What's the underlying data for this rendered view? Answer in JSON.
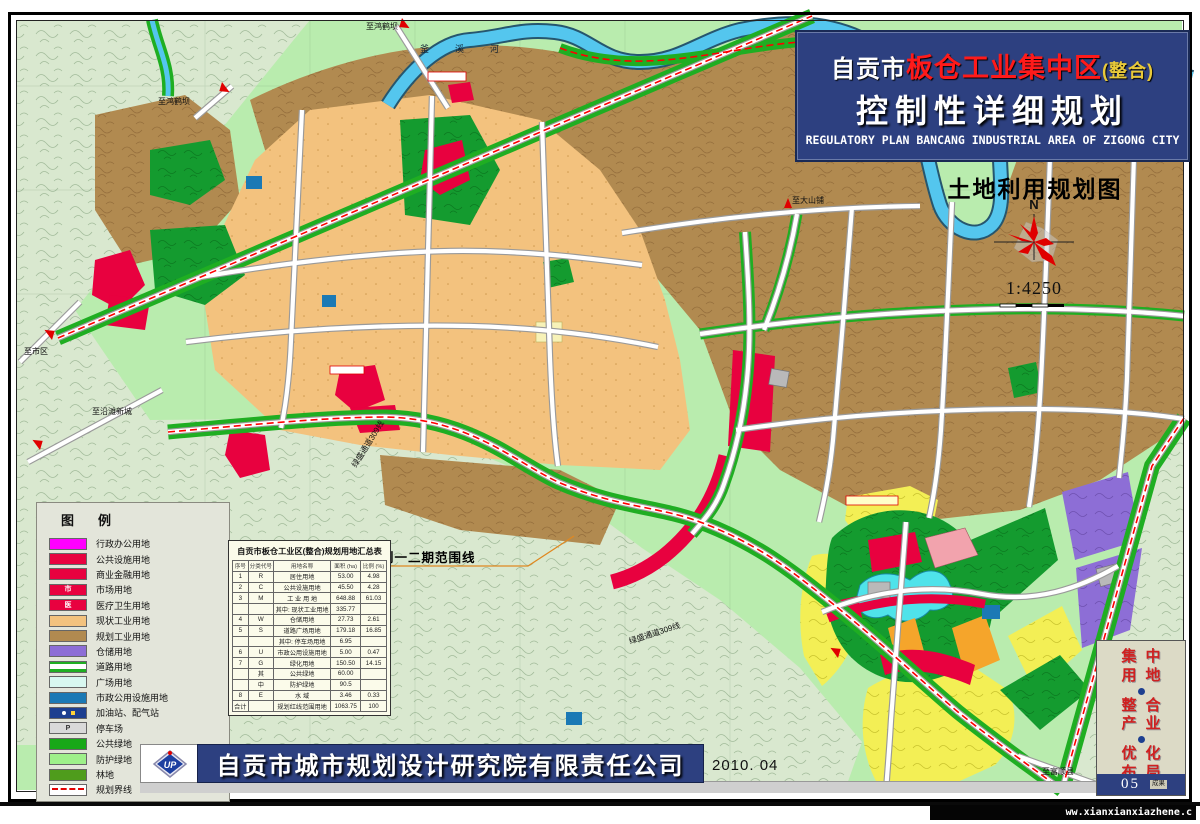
{
  "title_block": {
    "city": "自贡市",
    "name_red": "板仓工业集中区",
    "suffix": "(整合)",
    "line2": "控制性详细规划",
    "line_en": "REGULATORY PLAN BANCANG INDUSTRIAL AREA OF ZIGONG CITY"
  },
  "map_title": "土地利用规划图",
  "compass": {
    "north": "N",
    "scale": "1:4250"
  },
  "legend": {
    "title": "图例",
    "items": [
      {
        "label": "行政办公用地"
      },
      {
        "label": "公共设施用地"
      },
      {
        "label": "商业金融用地"
      },
      {
        "label": "市场用地",
        "symbol": "市"
      },
      {
        "label": "医疗卫生用地",
        "symbol": "医"
      },
      {
        "label": "现状工业用地"
      },
      {
        "label": "规划工业用地"
      },
      {
        "label": "仓储用地"
      },
      {
        "label": "道路用地"
      },
      {
        "label": "广场用地"
      },
      {
        "label": "市政公用设施用地"
      },
      {
        "label": "加油站、配气站"
      },
      {
        "label": "停车场",
        "symbol": "P"
      },
      {
        "label": "公共绿地"
      },
      {
        "label": "防护绿地"
      },
      {
        "label": "林地"
      },
      {
        "label": "规划界线"
      }
    ]
  },
  "table": {
    "title": "自贡市板仓工业区(整合)规划用地汇总表",
    "headers": [
      "序号",
      "分类代号",
      "用地名称",
      "面积 (ha)",
      "比例 (%)"
    ],
    "rows": [
      {
        "no": "1",
        "code": "R",
        "name": "居住用地",
        "area": "53.00",
        "pct": "4.98"
      },
      {
        "no": "2",
        "code": "C",
        "name": "公共设施用地",
        "area": "45.50",
        "pct": "4.28"
      },
      {
        "no": "3",
        "code": "M",
        "name": "工 业 用 地",
        "area": "648.88",
        "pct": "61.03"
      },
      {
        "no": "",
        "code": "",
        "name": "其中: 现状工业用地",
        "area": "335.77",
        "pct": ""
      },
      {
        "no": "4",
        "code": "W",
        "name": "仓储用地",
        "area": "27.73",
        "pct": "2.61"
      },
      {
        "no": "5",
        "code": "S",
        "name": "道路广场用地",
        "area": "179.18",
        "pct": "16.85"
      },
      {
        "no": "",
        "code": "",
        "name": "其中: 停车场用地",
        "area": "6.95",
        "pct": ""
      },
      {
        "no": "6",
        "code": "U",
        "name": "市政公用设施用地",
        "area": "5.00",
        "pct": "0.47"
      },
      {
        "no": "7",
        "code": "G",
        "name": "绿化用地",
        "area": "150.50",
        "pct": "14.15"
      },
      {
        "no": "",
        "code": "其",
        "name": "公共绿地",
        "area": "60.00",
        "pct": ""
      },
      {
        "no": "",
        "code": "中",
        "name": "防护绿地",
        "area": "90.5",
        "pct": ""
      },
      {
        "no": "8",
        "code": "E",
        "name": "水    域",
        "area": "3.46",
        "pct": "0.33"
      },
      {
        "no": "合计",
        "code": "",
        "name": "规划红线范围用地",
        "area": "1063.75",
        "pct": "100"
      }
    ]
  },
  "map_labels": {
    "river": "釜溪河",
    "to_honghebai_1": "至鸿鹤坝",
    "to_honghebai_2": "至鸿鹤坝",
    "to_dashanpu": "至大山铺",
    "to_city": "至市区",
    "to_yantan": "至沿滩新城",
    "to_fushun": "至富顺县",
    "greenway_1": "绿盛通道309线",
    "greenway_2": "绿盛通道309线",
    "boundary_note": "板仓工业区规划一二期范围线"
  },
  "footer": {
    "company": "自贡市城市规划设计研究院有限责任公司",
    "date": "2010. 04",
    "logo_text": "UP"
  },
  "side_panel": {
    "slogan": [
      "集中",
      "用地",
      "整合",
      "产业",
      "优化",
      "布局"
    ],
    "sheet_no": "05",
    "sheet_type": "成果"
  },
  "watermark": "ww.xianxianxiazhene.c",
  "colors": {
    "title_bg": "#2d4080",
    "map_bg": "#b9ecae",
    "existing_industrial": "#f3c27e",
    "planned_industrial": "#b18a50",
    "public_facility_red": "#e8013f",
    "admin_magenta": "#ff00ff",
    "warehouse_purple": "#8d6ed6",
    "green_belt": "#1fae22",
    "public_green": "#149b2f",
    "river_blue": "#54c6ee",
    "utility_blue": "#1b79b5",
    "residential_yellow": "#f3ef55",
    "boundary_red": "#ff0000"
  }
}
